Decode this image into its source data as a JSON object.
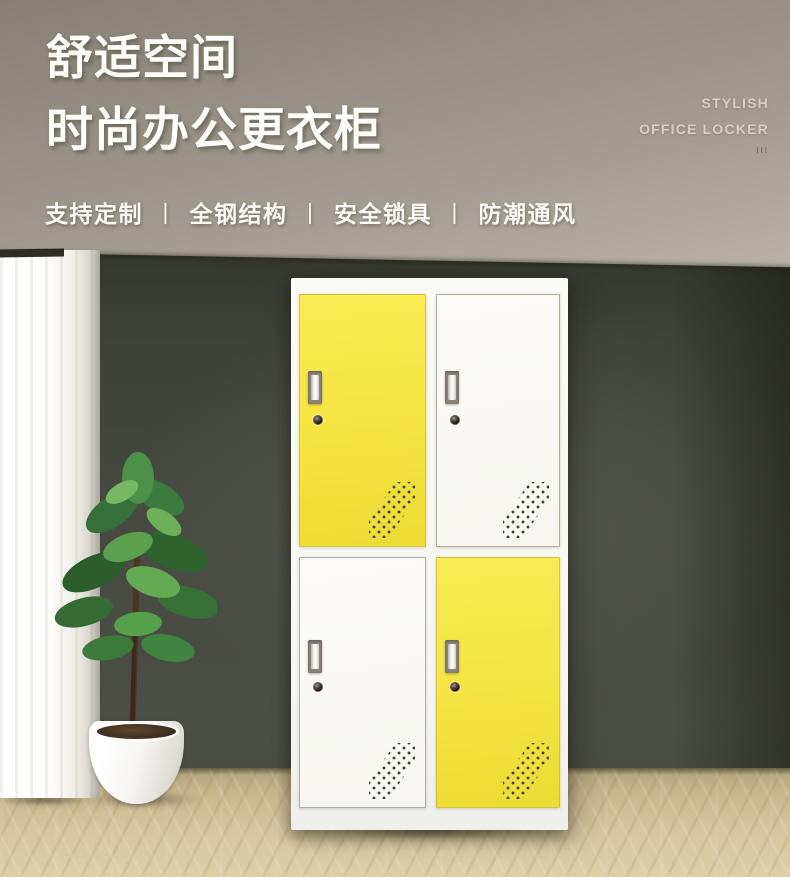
{
  "header": {
    "title_line1": "舒适空间",
    "title_line2": "时尚办公更衣柜",
    "features": [
      "支持定制",
      "全钢结构",
      "安全锁具",
      "防潮通风"
    ],
    "separator": "丨",
    "tagline_line1": "STYLISH",
    "tagline_line2": "OFFICE LOCKER",
    "tagline_marks": "III"
  },
  "locker": {
    "doors": [
      {
        "id": "top-left",
        "color": "yellow"
      },
      {
        "id": "top-right",
        "color": "white"
      },
      {
        "id": "bottom-left",
        "color": "white"
      },
      {
        "id": "bottom-right",
        "color": "yellow"
      }
    ]
  },
  "colors": {
    "accent_yellow": "#F5E440",
    "door_white": "#FBFAF7",
    "wall_dark": "#474A41",
    "ceiling_taupe": "#A29B90",
    "floor_wood": "#D5C59C",
    "title_text": "#FDFDFB",
    "tagline_text": "#D5CFC5"
  }
}
